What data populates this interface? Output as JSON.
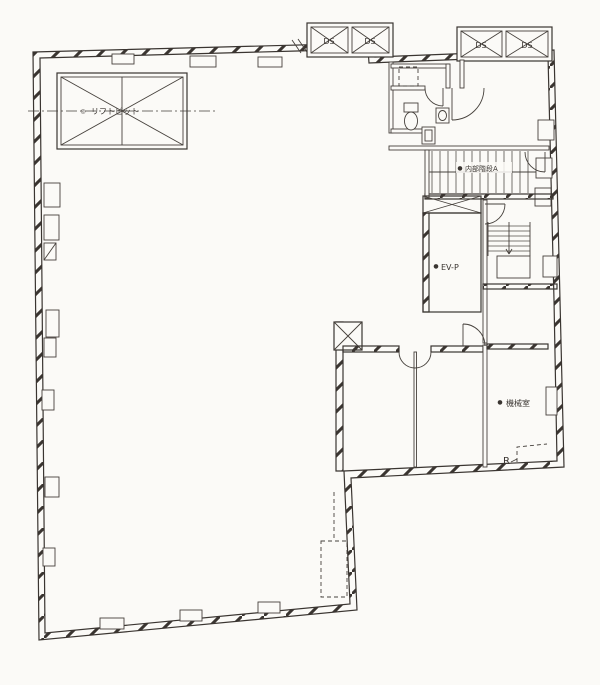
{
  "colors": {
    "ink": "#3a3531",
    "paper": "#fbfaf7"
  },
  "plan": {
    "lift_pit": {
      "bullet": "◎",
      "label": "リフトピット"
    },
    "duct_shaft": {
      "label": "DS"
    },
    "stair_a": {
      "bullet": "●",
      "label": "内部階段A"
    },
    "elevator": {
      "bullet": "●",
      "label": "EV-P"
    },
    "machine_room": {
      "bullet": "●",
      "label": "機械室"
    },
    "roof_drain": {
      "label": "R"
    }
  }
}
